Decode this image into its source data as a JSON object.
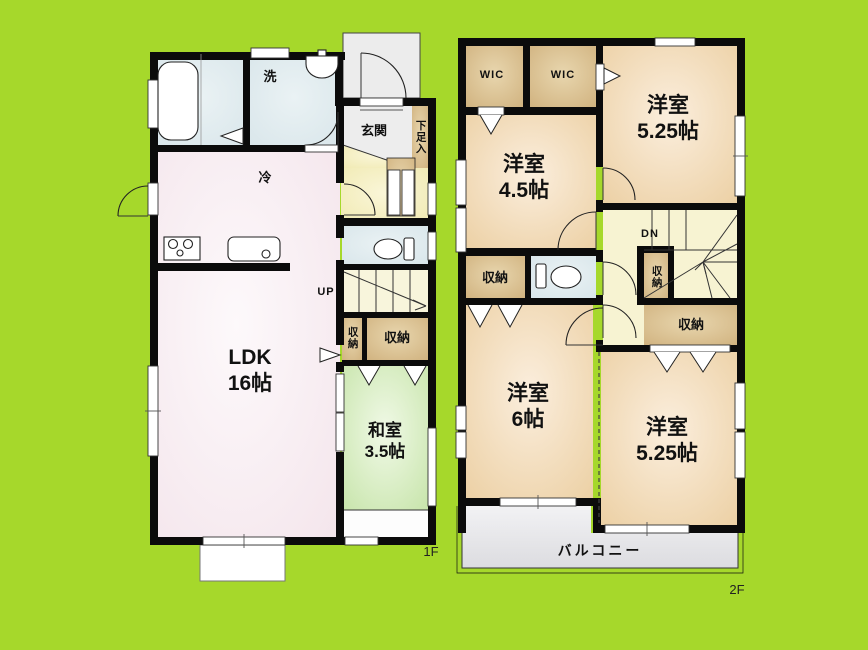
{
  "colors": {
    "background": "#a6d82b",
    "wall": "#0b0b0b",
    "room_peach": "#f2dcba",
    "room_tan": "#d8bd8e",
    "room_green": "#d5ecbd",
    "room_pink": "#f7eaf0",
    "room_blue": "#dde9ed",
    "hall_yellow": "#f3edba",
    "balcony_gray": "#e7e7ea"
  },
  "floor1": {
    "floor_label": "1F",
    "rooms": {
      "ldk": {
        "name": "LDK",
        "size": "16帖"
      },
      "washitsu": {
        "name": "和室",
        "size": "3.5帖"
      },
      "genkan": {
        "label": "玄関"
      },
      "shoe_cabinet": {
        "label": "下足入"
      },
      "laundry": {
        "label": "洗"
      },
      "fridge": {
        "label": "冷"
      },
      "stairs": {
        "label": "UP"
      },
      "storage_small": {
        "label": "収納"
      },
      "storage_large": {
        "label": "収納"
      }
    }
  },
  "floor2": {
    "floor_label": "2F",
    "rooms": {
      "wic_left": {
        "label": "WIC"
      },
      "wic_right": {
        "label": "WIC"
      },
      "bedroom_top": {
        "name": "洋室",
        "size": "5.25帖"
      },
      "bedroom_left": {
        "name": "洋室",
        "size": "4.5帖"
      },
      "bedroom_bottom_left": {
        "name": "洋室",
        "size": "6帖"
      },
      "bedroom_bottom_right": {
        "name": "洋室",
        "size": "5.25帖"
      },
      "stairs": {
        "label": "DN"
      },
      "storage_left": {
        "label": "収納"
      },
      "storage_mid": {
        "label": "収納"
      },
      "storage_right": {
        "label": "収納"
      },
      "balcony": {
        "label": "バルコニー"
      }
    }
  }
}
